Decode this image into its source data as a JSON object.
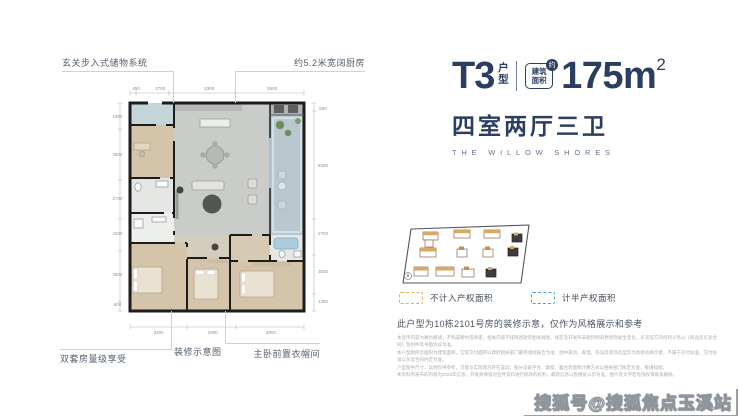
{
  "header": {
    "unit_code": "T3",
    "unit_suffix": "户型",
    "badge": {
      "line1": "建筑",
      "line2": "面积",
      "approx": "约"
    },
    "area_value": "175m",
    "area_exponent": "2",
    "rooms_line": "四室两厅三卫",
    "subtitle_en": "THE WILLOW SHORES"
  },
  "floorplan": {
    "caption": "装修示意图",
    "annotations": {
      "top_left": "玄关步入式储物系统",
      "top_right": "约5.2米宽阔厨房",
      "bottom_left": "双套房量级享受",
      "bottom_right": "主卧前置衣帽间"
    },
    "dimensions": {
      "top": [
        "450",
        "2700",
        "5300",
        "5500"
      ],
      "bottom": [
        "3400",
        "2900",
        "4000"
      ],
      "left": [
        "1800",
        "3600",
        "2700",
        "2200",
        "3600",
        "600"
      ],
      "right": [
        "600",
        "8300",
        "2700",
        "3000",
        "1300"
      ]
    }
  },
  "legend": [
    {
      "label": "不计入产权面积",
      "color": "#E3B44C"
    },
    {
      "label": "计半产权面积",
      "color": "#4FA0CE"
    }
  ],
  "disclaimer": {
    "headline": "此户型为10栋2101号房的装修示意，仅作为风格展示和参考",
    "fine_print": [
      "本宣传内容为要约邀请，不构成要约或承诺，相关内容不排除因政府相关规划、规定及开发商未能控制的原因而发生变化，买卖双方的权利义务以《商品房买卖合同》及附件等书面协议为准。",
      "本户型图所示面积为建筑面积，实际交付面积以政府相关部门最终测绘报告为准；图中家具、家电、陈设及装饰造型仅为装修风格示意，不属于交付标准，交付标准以买卖合同约定为准。",
      "户型图中尺寸、比例仅供参考，可能与实际情况存在差异；部分设备平台、飘窗、露台等面积计算方式以相关部门核定为准，敬请知悉。",
      "本资料所发布的内容为2023年信息，开发商保留对宣传资料进行修改的权利，最新信息以售楼处公示为准。图片及文字若有侵权请联系删除。"
    ]
  },
  "watermark": "搜狐号@搜狐焦点玉溪站",
  "colors": {
    "navy": "#2B3E61",
    "legend_yellow": "#E3B44C",
    "legend_blue": "#4FA0CE"
  }
}
